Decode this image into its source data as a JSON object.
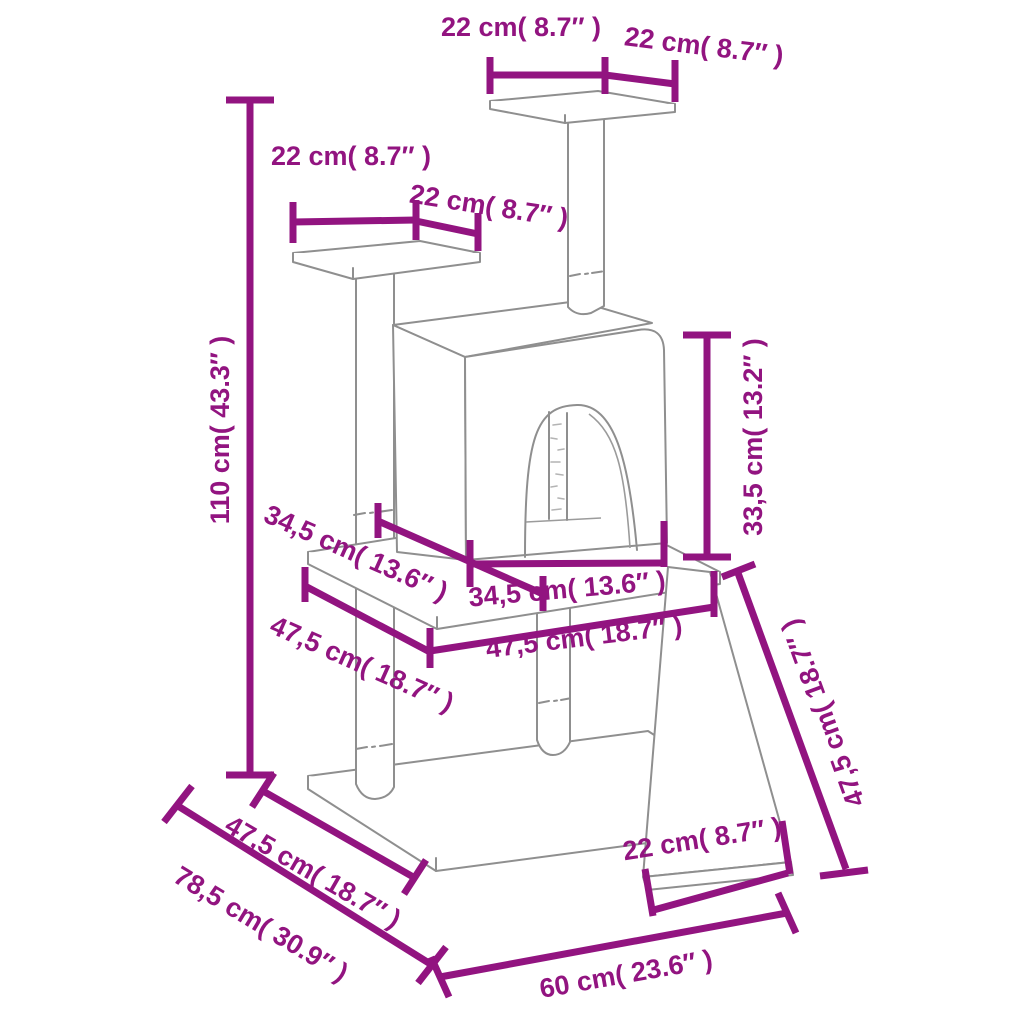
{
  "diagram": {
    "type": "product-dimension-diagram",
    "subject": "cat tree with scratching posts, condo, platforms, base and ramp",
    "background_color": "#ffffff",
    "outline_color": "#8f8f8f",
    "dimension_color": "#921480",
    "dimensions": [
      {
        "id": "top-platform-width",
        "label": "22 cm( 8.7″ )",
        "cm": "22",
        "inches": "8.7",
        "x": 521,
        "y": 27,
        "rotate": 0
      },
      {
        "id": "top-platform-depth",
        "label": "22 cm( 8.7″ )",
        "cm": "22",
        "inches": "8.7",
        "x": 704,
        "y": 46,
        "rotate": 7
      },
      {
        "id": "left-platform-width",
        "label": "22 cm( 8.7″ )",
        "cm": "22",
        "inches": "8.7",
        "x": 351,
        "y": 156,
        "rotate": 0
      },
      {
        "id": "left-platform-depth",
        "label": "22 cm( 8.7″ )",
        "cm": "22",
        "inches": "8.7",
        "x": 489,
        "y": 206,
        "rotate": 9
      },
      {
        "id": "total-height",
        "label": "110 cm( 43.3″ )",
        "cm": "110",
        "inches": "43.3",
        "x": 220,
        "y": 430,
        "rotate": -90
      },
      {
        "id": "middle-board-depth",
        "label": "34,5 cm( 13.6″ )",
        "cm": "34,5",
        "inches": "13.6",
        "x": 356,
        "y": 553,
        "rotate": 24
      },
      {
        "id": "lower-level-diagonal",
        "label": "47,5 cm( 18.7″ )",
        "cm": "47,5",
        "inches": "18.7",
        "x": 362,
        "y": 664,
        "rotate": 24
      },
      {
        "id": "condo-width",
        "label": "34,5 cm( 13.6″ )",
        "cm": "34,5",
        "inches": "13.6",
        "x": 567,
        "y": 589,
        "rotate": -5
      },
      {
        "id": "condo-height",
        "label": "33,5 cm( 13.2″ )",
        "cm": "33,5",
        "inches": "13.2",
        "x": 753,
        "y": 437,
        "rotate": -90
      },
      {
        "id": "middle-board-width",
        "label": "47,5 cm( 18.7″ )",
        "cm": "47,5",
        "inches": "18.7",
        "x": 584,
        "y": 637,
        "rotate": -7
      },
      {
        "id": "ramp-length",
        "label": "47,5 cm( 18.7″ )",
        "cm": "47,5",
        "inches": "18.7",
        "x": 823,
        "y": 713,
        "rotate": -110
      },
      {
        "id": "base-depth",
        "label": "47,5 cm( 18.7″ )",
        "cm": "47,5",
        "inches": "18.7",
        "x": 313,
        "y": 872,
        "rotate": 30
      },
      {
        "id": "base-diagonal",
        "label": "78,5 cm( 30.9″ )",
        "cm": "78,5",
        "inches": "30.9",
        "x": 261,
        "y": 924,
        "rotate": 31
      },
      {
        "id": "ramp-width",
        "label": "22 cm( 8.7″ )",
        "cm": "22",
        "inches": "8.7",
        "x": 702,
        "y": 839,
        "rotate": -9
      },
      {
        "id": "base-width",
        "label": "60 cm( 23.6″ )",
        "cm": "60",
        "inches": "23.6",
        "x": 626,
        "y": 974,
        "rotate": -10
      }
    ]
  }
}
